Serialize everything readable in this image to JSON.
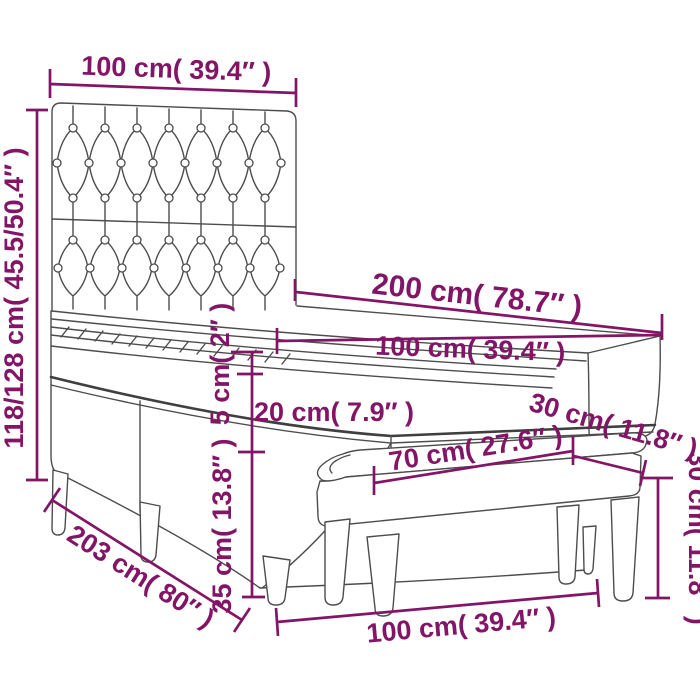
{
  "diagram": {
    "type": "product-dimension-diagram",
    "product": "box spring bed with tufted headboard, mattress topper and bench",
    "accent_color": "#831566",
    "line_color": "#4d4d4d",
    "background": "#ffffff",
    "labels": {
      "headboard_width": "100 cm( 39.4″ )",
      "overall_height": "118/128 cm( 45.5/50.4″ )",
      "bed_length": "200 cm( 78.7″ )",
      "mattress_width": "100 cm( 39.4″ )",
      "topper_thickness": "5 cm( 2″ )",
      "mattress_thickness": "20 cm( 7.9″ )",
      "base_height": "35 cm( 13.8″ )",
      "overall_length": "203 cm( 80″ )",
      "bed_width": "100 cm( 39.4″ )",
      "bench_length": "70 cm( 27.6″ )",
      "bench_depth": "30 cm( 11.8″ )",
      "bench_height": "30 cm( 11.8″ )"
    }
  }
}
